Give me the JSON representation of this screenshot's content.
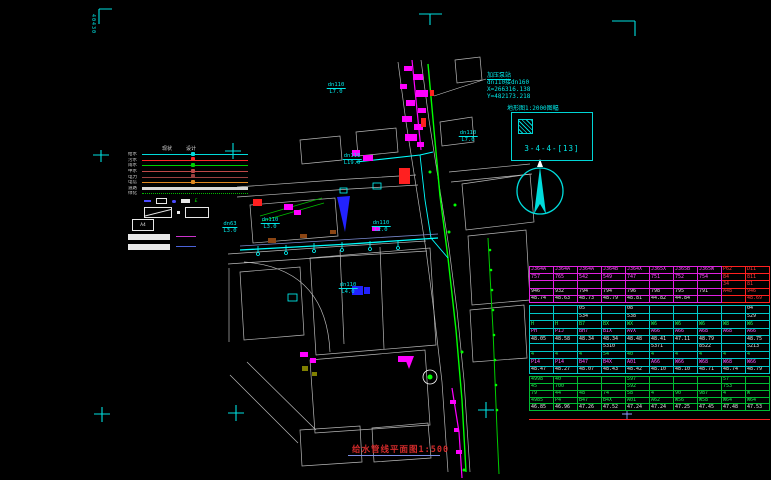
{
  "frame": {
    "sheet_label": "40430",
    "title": "给水管线平面图1:500"
  },
  "map_key": {
    "grid_note": "地形图1:2000图幅",
    "sheet_ref": "3-4-4-[13]"
  },
  "pump_note": {
    "line1": "加压泵站",
    "line2": "dn110接dn160",
    "line3": "X=266316.138",
    "line4": "Y=482173.218"
  },
  "colors": {
    "water_main": "#00ff00",
    "annotation": "#00e8e8",
    "cluster": "#ff00ff",
    "alert": "#ff2020",
    "parcel": "#b8b8b8"
  },
  "legend": {
    "col_headers": [
      "现状",
      "设计"
    ],
    "lines": [
      {
        "label": "给水",
        "color": "#00dcdc",
        "style": "solid"
      },
      {
        "label": "污水",
        "color": "#ff2828",
        "style": "solid"
      },
      {
        "label": "雨水",
        "color": "#00cc00",
        "style": "solid"
      },
      {
        "label": "中水",
        "color": "#c04848",
        "style": "solid"
      },
      {
        "label": "电力",
        "color": "#9a4040",
        "style": "solid"
      },
      {
        "label": "电信",
        "color": "#e08820",
        "style": "solid"
      },
      {
        "label": "道路",
        "color": "#d8d8d8",
        "style": "thick"
      },
      {
        "label": "绿化",
        "color": "#00bb00",
        "style": "dotted"
      }
    ],
    "symbols": [
      {
        "name": "valve",
        "glyph": ""
      },
      {
        "name": "meter-box",
        "glyph": ""
      },
      {
        "name": "node",
        "glyph": ""
      },
      {
        "name": "chamber",
        "glyph": ""
      },
      {
        "name": "hydrant",
        "glyph": "£"
      }
    ],
    "a4_label": "A4"
  },
  "annotations": [
    {
      "size": "dn110",
      "len": "L7.0",
      "x": 336,
      "y": 82
    },
    {
      "size": "dn110",
      "len": "L7.0",
      "x": 468,
      "y": 130
    },
    {
      "size": "dn110",
      "len": "L19.0",
      "x": 352,
      "y": 153
    },
    {
      "size": "dn63",
      "len": "L3.0",
      "x": 230,
      "y": 221
    },
    {
      "size": "dn110",
      "len": "L3.0",
      "x": 270,
      "y": 217
    },
    {
      "size": "dn110",
      "len": "L2.0",
      "x": 381,
      "y": 220
    },
    {
      "size": "dn110",
      "len": "L4.0",
      "x": 348,
      "y": 282
    }
  ],
  "table": {
    "sections": [
      {
        "name": "node-block-1",
        "red_cols": [
          8,
          9
        ],
        "rows": [
          {
            "color": "m",
            "cells": [
              "J364A",
              "J364A",
              "J364A",
              "J364B",
              "J364X",
              "J365X",
              "J365B",
              "J365W",
              "P62",
              "D11"
            ]
          },
          {
            "color": "m",
            "cells": [
              "757",
              "765",
              "542",
              "549",
              "747",
              "751",
              "752",
              "754",
              "84",
              "811"
            ]
          },
          {
            "color": "m",
            "cells": [
              "",
              "",
              "",
              "",
              "",
              "",
              "",
              "",
              "34",
              "81"
            ]
          },
          {
            "color": "w",
            "cells": [
              "946",
              "932",
              "794",
              "794",
              "796",
              "798",
              "795",
              "791",
              "A48",
              "946"
            ]
          },
          {
            "color": "w",
            "cells": [
              "48.74",
              "48.63",
              "48.73",
              "48.79",
              "48.81",
              "44.82",
              "44.84",
              "",
              "",
              "48.69"
            ]
          }
        ]
      },
      {
        "name": "node-block-2",
        "red_cols": [],
        "rows": [
          {
            "color": "w",
            "cells": [
              "",
              "",
              "05",
              "",
              "08",
              "",
              "",
              "",
              "",
              "04"
            ]
          },
          {
            "color": "w",
            "cells": [
              "",
              "",
              "534",
              "",
              "538",
              "",
              "",
              "",
              "",
              "529"
            ]
          },
          {
            "color": "g",
            "cells": [
              "H",
              "H",
              "B7",
              "BX",
              "WX",
              "W6",
              "W6",
              "W6",
              "W8",
              "W6"
            ]
          },
          {
            "color": "m",
            "cells": [
              "PH",
              "PIJ",
              "BH7",
              "BIX",
              "AVX",
              "A66",
              "A66",
              "A68",
              "A68",
              "A66"
            ]
          },
          {
            "color": "w",
            "cells": [
              "48.05",
              "48.58",
              "48.34",
              "48.34",
              "48.48",
              "48.41",
              "47.11",
              "48.79",
              "",
              "48.75"
            ]
          },
          {
            "color": "w",
            "cells": [
              "",
              "",
              "",
              "5310",
              "",
              "5371",
              "",
              "8522",
              "",
              "5213"
            ]
          },
          {
            "color": "g",
            "cells": [
              "4",
              "4",
              "4",
              "54",
              "40",
              "4",
              "4",
              "4",
              "4",
              "4"
            ]
          },
          {
            "color": "m",
            "cells": [
              "P14",
              "P14",
              "B47",
              "B4X",
              "A01",
              "A66",
              "W66",
              "W68",
              "W68",
              "W66"
            ]
          },
          {
            "color": "w",
            "cells": [
              "48.47",
              "48.27",
              "48.07",
              "48.43",
              "48.42",
              "48.10",
              "48.10",
              "48.71",
              "48.74",
              "48.79"
            ]
          }
        ]
      },
      {
        "name": "node-block-3",
        "red_cols": [],
        "rows": [
          {
            "color": "g",
            "cells": [
              "4998",
              "40",
              "",
              "",
              "597",
              "",
              "",
              "",
              "57",
              ""
            ]
          },
          {
            "color": "g",
            "cells": [
              "45",
              "700",
              "",
              "",
              "592",
              "",
              "",
              "",
              "753",
              ""
            ]
          },
          {
            "color": "g",
            "cells": [
              "79",
              "44",
              "48",
              "74",
              "58",
              "4",
              "90",
              "987",
              "4",
              "W"
            ]
          },
          {
            "color": "g",
            "cells": [
              "4985",
              "P4",
              "B47",
              "B4X",
              "A01",
              "A62",
              "W56",
              "W58",
              "W64",
              "W64"
            ]
          },
          {
            "color": "w",
            "cells": [
              "46.85",
              "46.96",
              "47.26",
              "47.52",
              "47.24",
              "47.24",
              "47.25",
              "47.45",
              "47.48",
              "47.53"
            ]
          }
        ]
      }
    ]
  }
}
